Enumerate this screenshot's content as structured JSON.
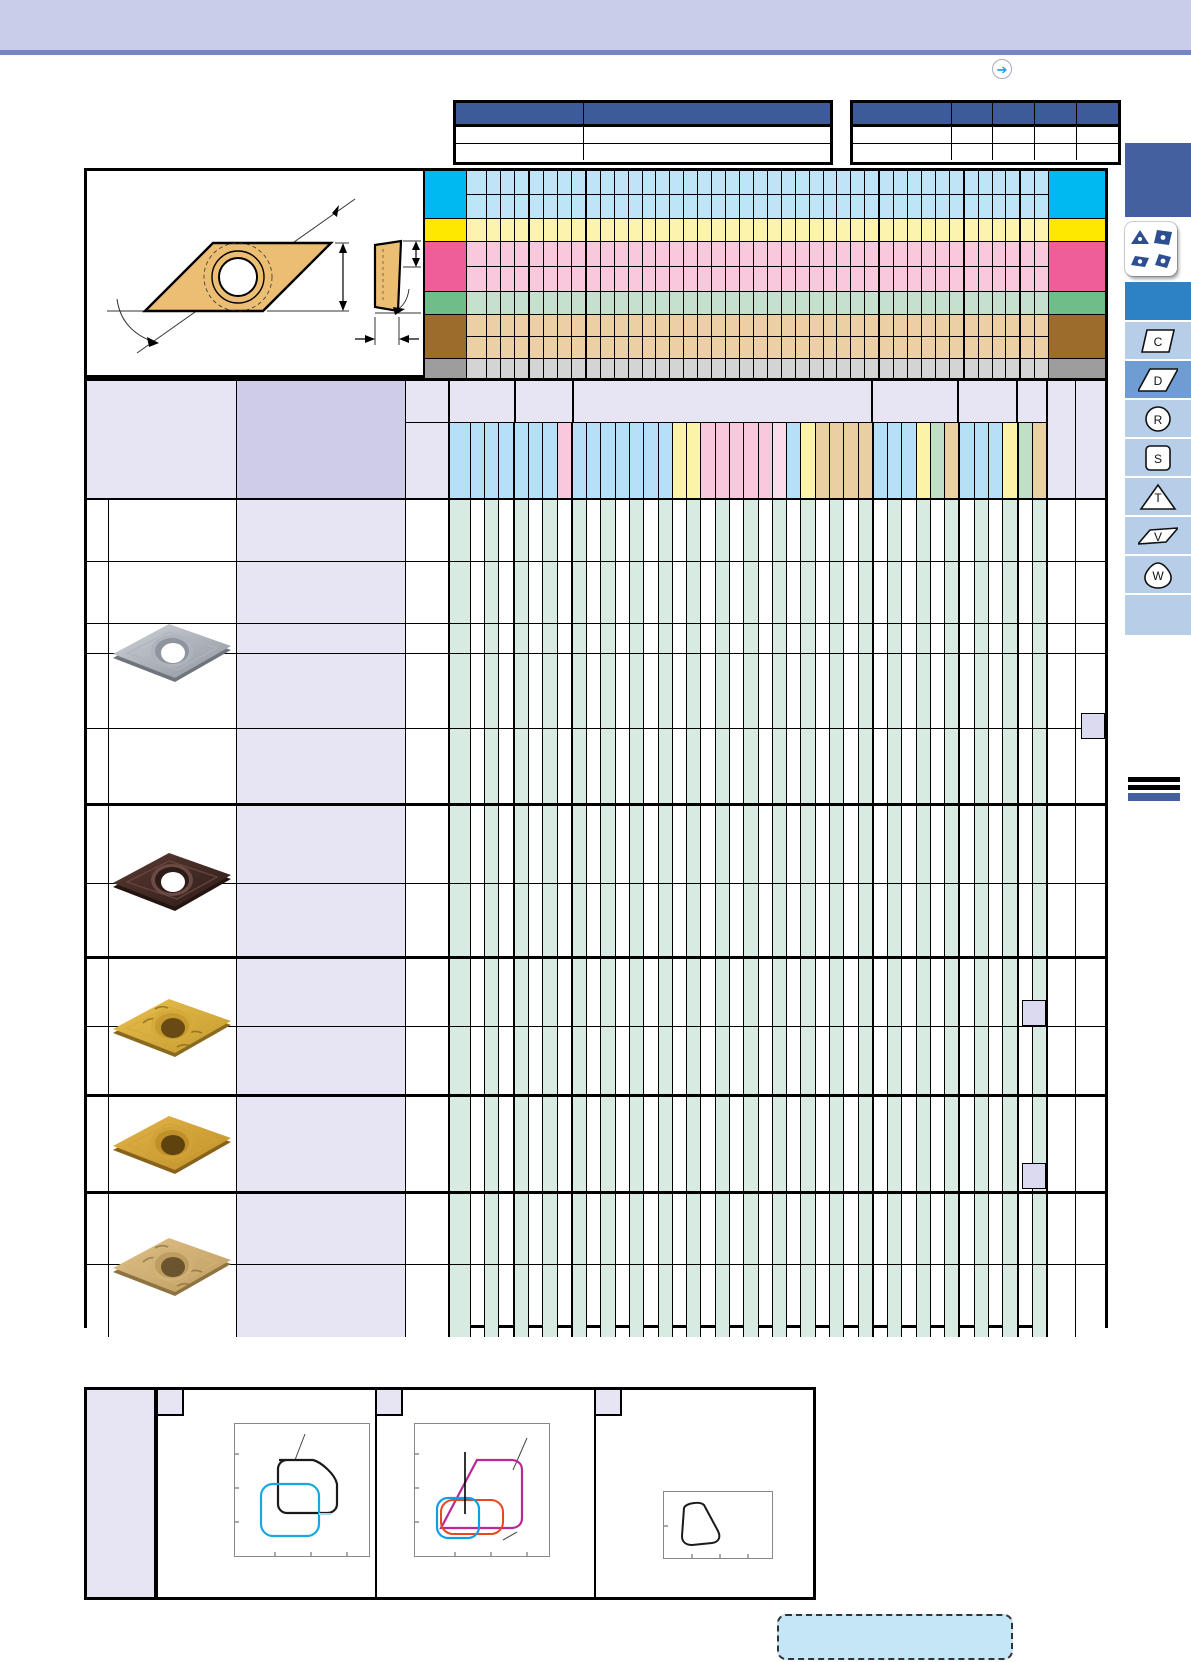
{
  "banner": {
    "color": "#c9cde9",
    "rule_color": "#7584c4"
  },
  "nav_arrow": {
    "glyph": "➔",
    "color": "#18a0e8"
  },
  "header_tables": {
    "header_color": "#3d5a99",
    "left": {
      "col_widths": [
        127,
        247
      ],
      "body_rows": 2
    },
    "right": {
      "col_widths": [
        98,
        41,
        42,
        42,
        42
      ],
      "body_rows": 2
    }
  },
  "application_map": {
    "bands": [
      {
        "key": "cyan",
        "solid": "#00b9f0",
        "light": "#bfe4f7",
        "subrows": [
          23,
          23
        ]
      },
      {
        "key": "yellow",
        "solid": "#ffe800",
        "light": "#fcf4ae",
        "subrows": [
          22
        ]
      },
      {
        "key": "pink",
        "solid": "#ee5f9a",
        "light": "#f8c8dc",
        "subrows": [
          24,
          24
        ]
      },
      {
        "key": "green",
        "solid": "#6fbe8a",
        "light": "#c5e0cd",
        "subrows": [
          22
        ]
      },
      {
        "key": "brown",
        "solid": "#9c6c2c",
        "light": "#eccfa4",
        "subrows": [
          21,
          21
        ]
      },
      {
        "key": "gray",
        "solid": "#9d9d9d",
        "light": "#d4d4d4",
        "subrows": [
          21
        ]
      }
    ]
  },
  "columns": {
    "group_sizes": [
      4,
      4,
      21,
      6,
      4,
      2
    ],
    "strip_palette": {
      "blue": "#b5e0f8",
      "yellow": "#fbf3a8",
      "pink": "#f8c8dc",
      "lightpink": "#fbdcea",
      "green": "#c0dfc8",
      "tan": "#e9cfa2"
    },
    "strip_colors": [
      "blue",
      "blue",
      "blue",
      "blue",
      "blue",
      "blue",
      "blue",
      "pink",
      "blue",
      "blue",
      "blue",
      "blue",
      "blue",
      "blue",
      "blue",
      "yellow",
      "yellow",
      "pink",
      "pink",
      "pink",
      "pink",
      "pink",
      "lightpink",
      "blue",
      "yellow",
      "tan",
      "tan",
      "tan",
      "tan",
      "blue",
      "blue",
      "blue",
      "yellow",
      "green",
      "tan",
      "blue",
      "blue",
      "blue",
      "yellow",
      "green",
      "tan"
    ],
    "mint": "#d8ebe2",
    "header_lavender_light": "#e7e5f4",
    "header_lavender_medium": "#cfccea"
  },
  "insert_groups": [
    {
      "style": "silver",
      "rows": [
        61,
        62,
        30,
        75,
        75
      ]
    },
    {
      "style": "dark-brown",
      "rows": [
        77,
        73
      ]
    },
    {
      "style": "gold-textured",
      "rows": [
        67,
        68
      ]
    },
    {
      "style": "gold",
      "rows": [
        94
      ]
    },
    {
      "style": "bronze",
      "rows": [
        70,
        73
      ]
    }
  ],
  "insert_palettes": {
    "silver": {
      "b1": "#cfd4da",
      "b2": "#8f959e",
      "edge": "#70757d",
      "rim": "#aeb4bc",
      "hole": "#ffffff",
      "tex": false
    },
    "dark-brown": {
      "b1": "#5a3a32",
      "b2": "#2e1c18",
      "edge": "#241511",
      "rim": "#6a4a42",
      "hole": "#ffffff",
      "tex": false
    },
    "gold-textured": {
      "b1": "#e8c04e",
      "b2": "#c69a30",
      "edge": "#8a6a1e",
      "rim": "#d4aa3a",
      "hole": "#6a4a14",
      "tex": true
    },
    "gold": {
      "b1": "#e2b54a",
      "b2": "#c09028",
      "edge": "#86621a",
      "rim": "#d0a238",
      "hole": "#5e430f",
      "tex": false
    },
    "bronze": {
      "b1": "#e0c28a",
      "b2": "#bf9c60",
      "edge": "#8d7340",
      "rim": "#d2b176",
      "hole": "#6b5430",
      "tex": true
    }
  },
  "ref_boxes": [
    {
      "x": 1081,
      "y": 713
    },
    {
      "x": 1022,
      "y": 1000
    },
    {
      "x": 1022,
      "y": 1163
    }
  ],
  "sidebar": {
    "top_block_color": "#44609e",
    "mid_block_color": "#2c82c4",
    "tab_color": "#b7cee9",
    "active_tab_color": "#6f9cd2",
    "legend_shape_color": "#2d4f92",
    "tabs": [
      {
        "label": "C",
        "shape": "parallelogram",
        "active": false
      },
      {
        "label": "D",
        "shape": "parallelogram-wide",
        "active": true
      },
      {
        "label": "R",
        "shape": "circle",
        "active": false
      },
      {
        "label": "S",
        "shape": "square",
        "active": false
      },
      {
        "label": "T",
        "shape": "triangle",
        "active": false
      },
      {
        "label": "V",
        "shape": "parallelogram-thin",
        "active": false
      },
      {
        "label": "W",
        "shape": "trigon",
        "active": false
      }
    ]
  },
  "breaker_panels": [
    {
      "shapes": [
        "black-outline",
        "cyan-outline"
      ],
      "outline_colors": [
        "#1a1a1a",
        "#18a8e0"
      ]
    },
    {
      "shapes": [
        "magenta-outline",
        "blue-outline",
        "red-outline"
      ],
      "outline_colors": [
        "#b8289a",
        "#0aa0e8",
        "#e84820"
      ]
    },
    {
      "shapes": [
        "black-outline"
      ],
      "outline_colors": [
        "#1a1a1a"
      ]
    }
  ],
  "note_box": {
    "fill": "#c5e6f7"
  }
}
